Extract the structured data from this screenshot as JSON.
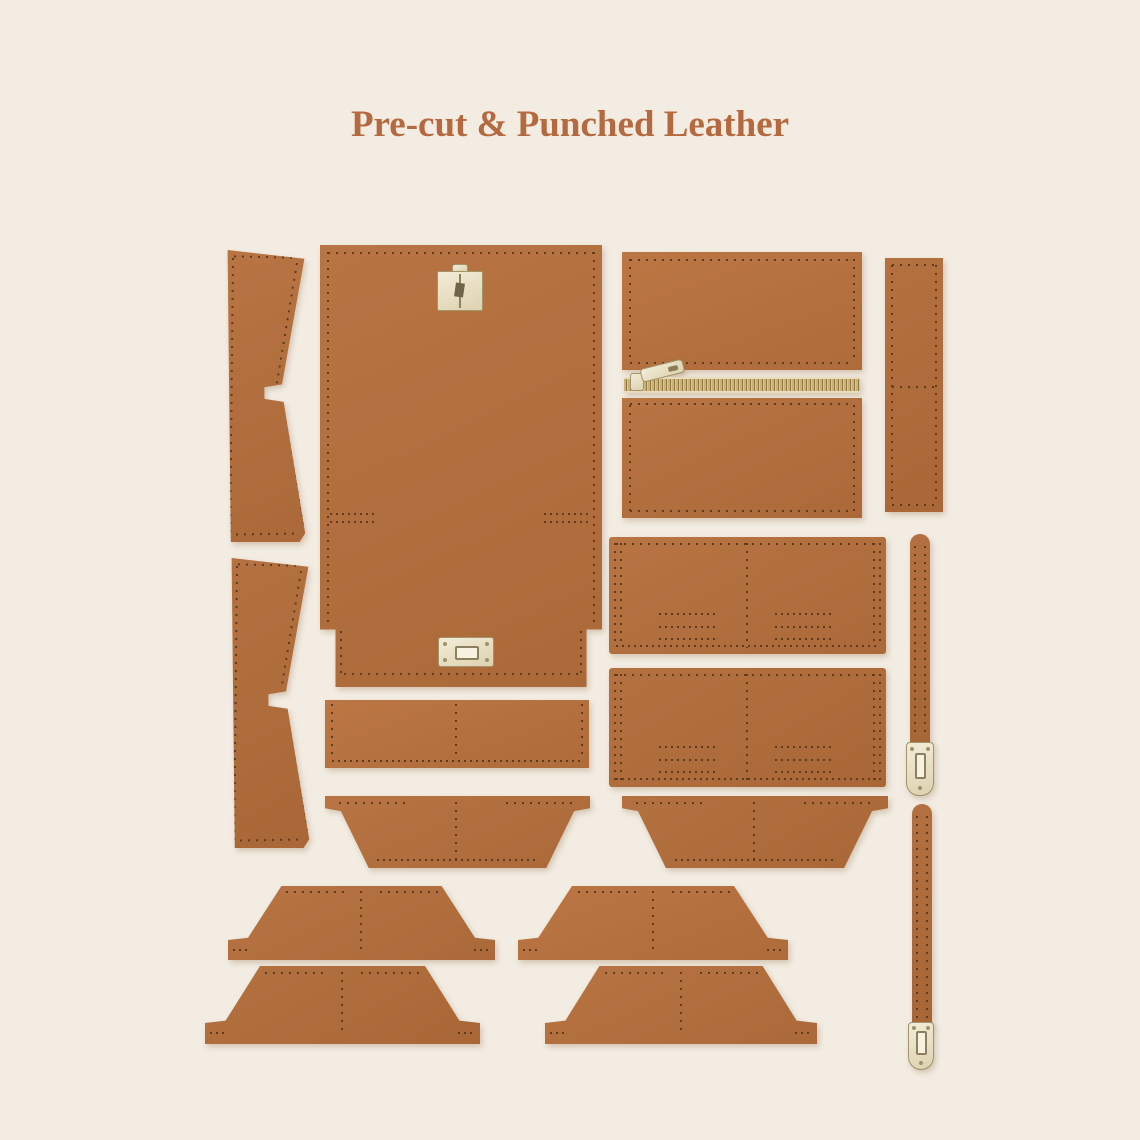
{
  "title": "Pre-cut & Punched Leather",
  "colors": {
    "background": "#f2ece2",
    "title": "#b5693f",
    "leather": "#b06f3e",
    "leather_dark": "#8a5530",
    "stitch": "#5f3b20",
    "metal": "#e8dfc6",
    "metal_border": "#a2946c"
  }
}
